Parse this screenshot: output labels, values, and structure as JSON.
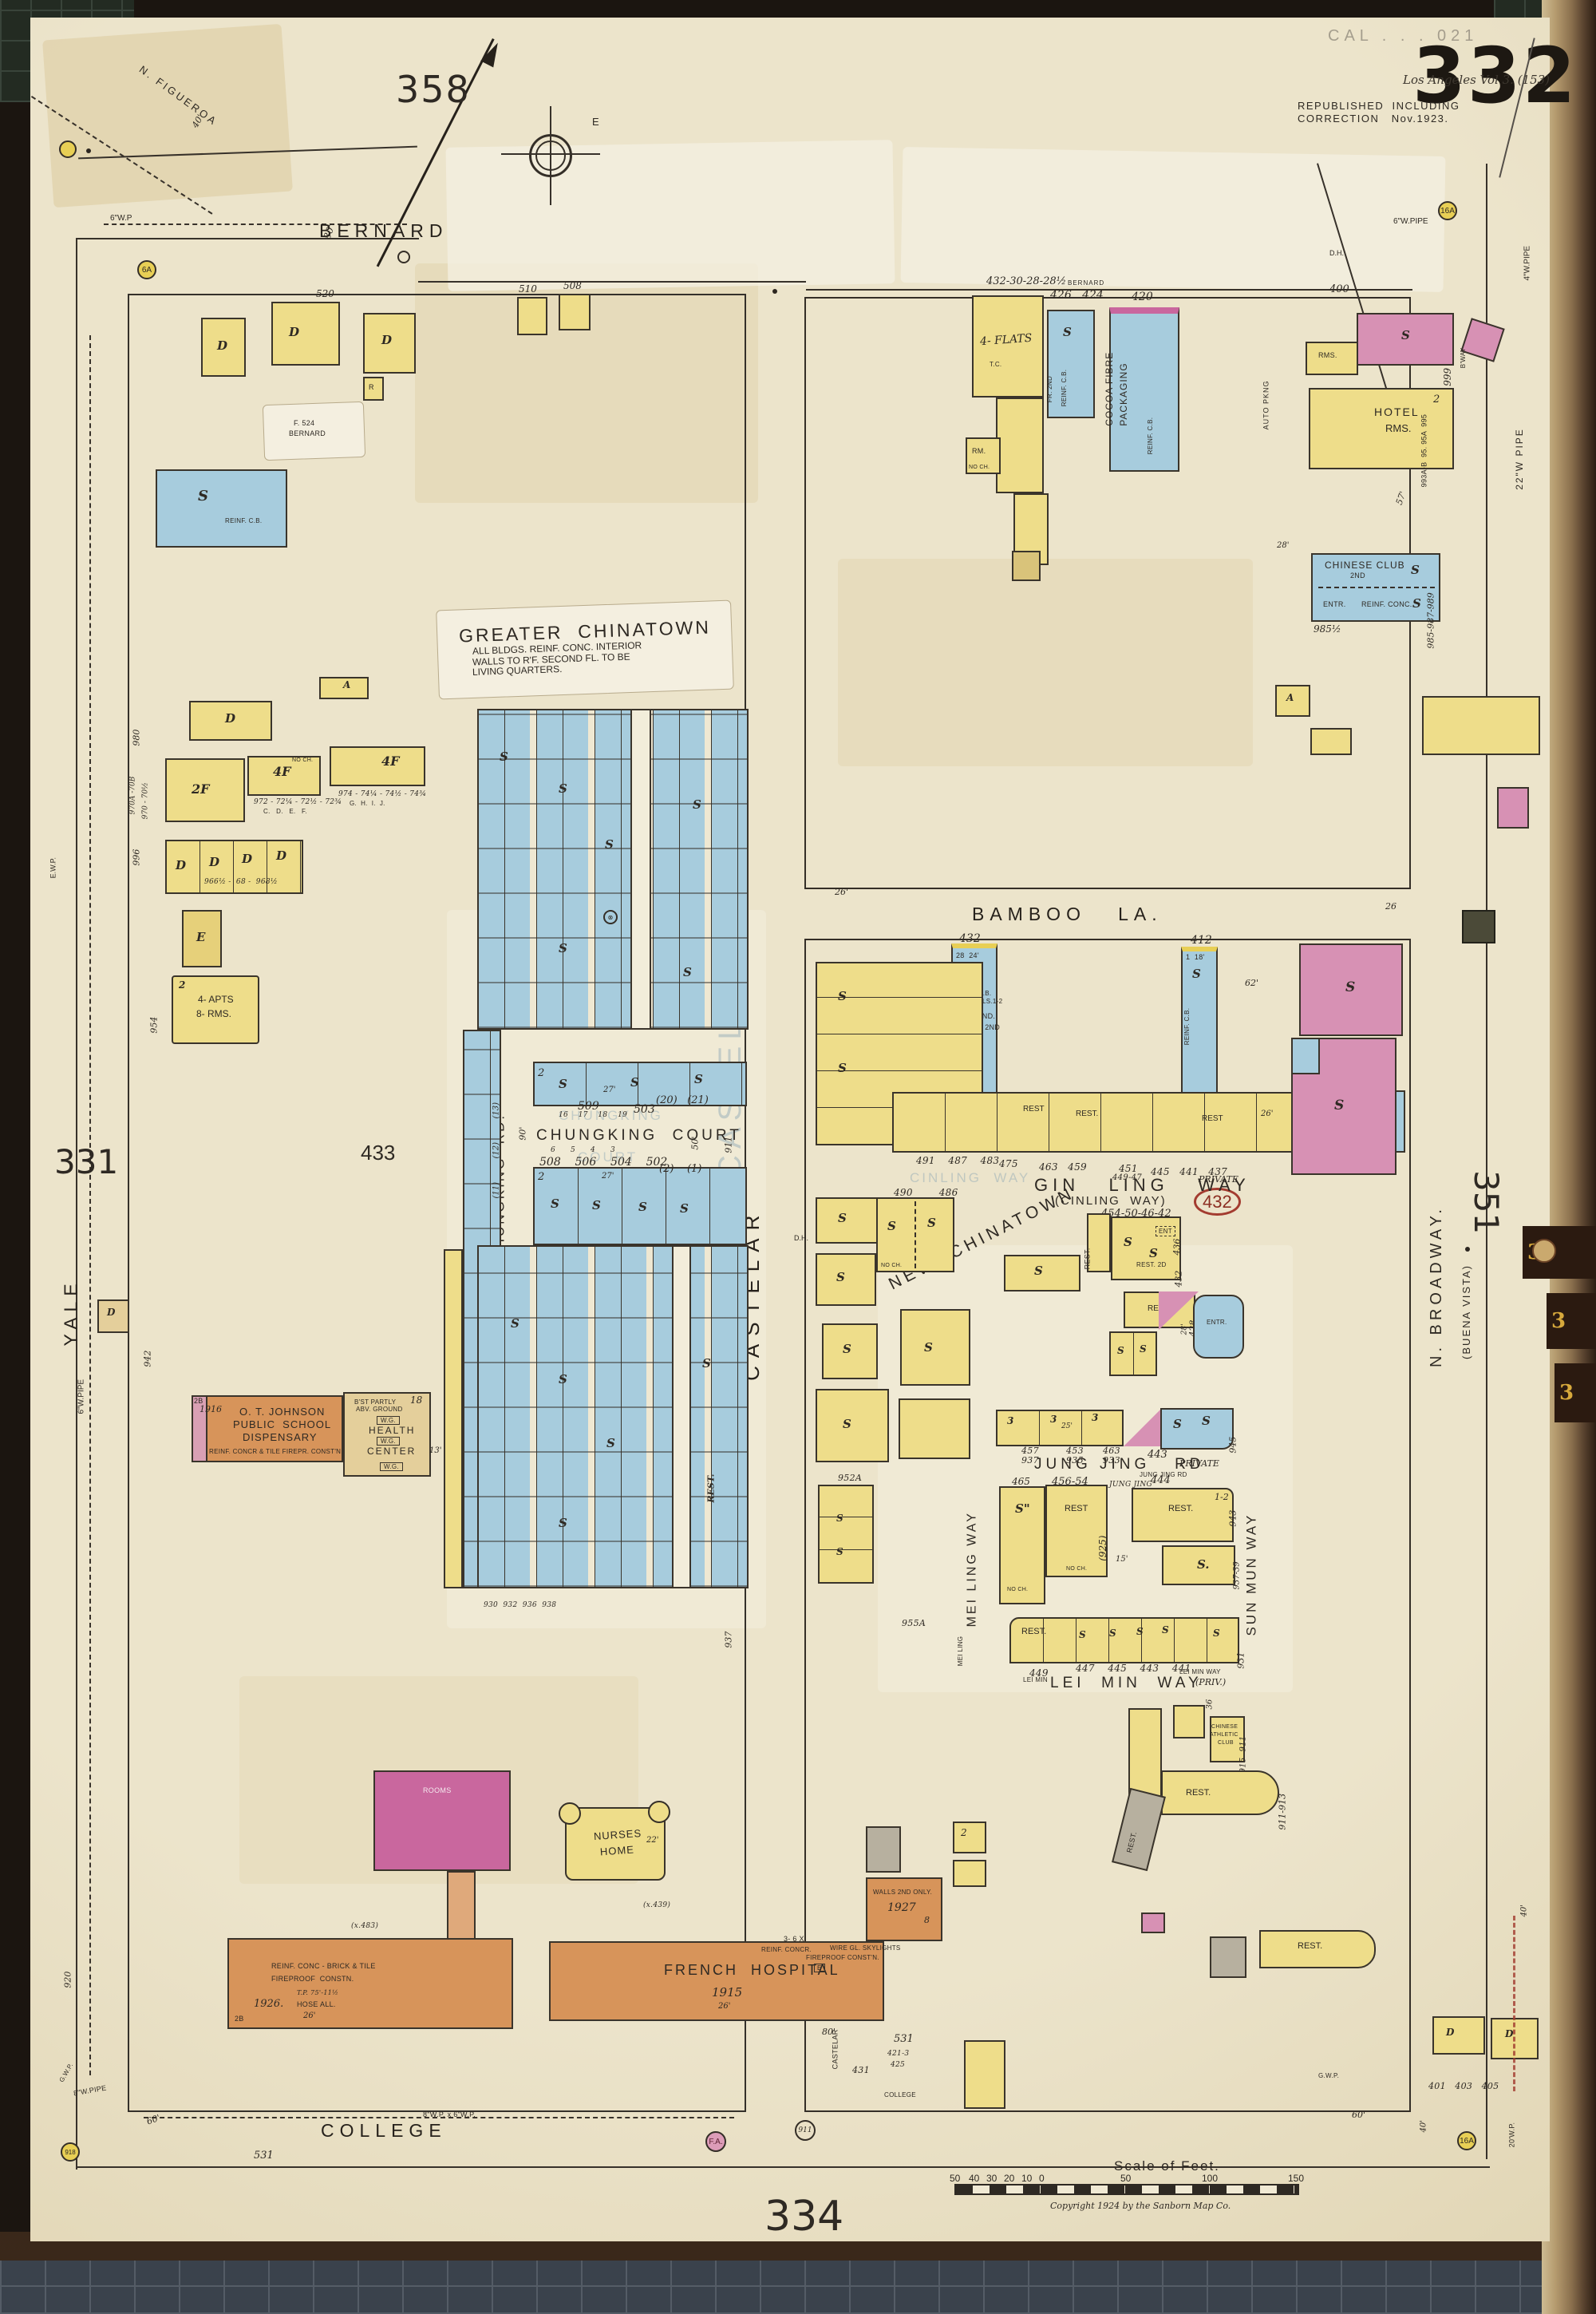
{
  "page": {
    "sheet": "332",
    "vol_stamp": "Los Angeles Vol 3. (153)",
    "faint_stamp": "CAL . . . 021",
    "rep1": "REPUBLISHED  INCLUDING",
    "rep2": "CORRECTION   Nov.1923.",
    "adj_top": "358",
    "adj_bottom": "334",
    "adj_left": "331",
    "adj_right": "351",
    "block_433": "433",
    "red_432": "432",
    "compass_e": "E"
  },
  "streets": {
    "bernard": "BERNARD",
    "bernard2": "BERNARD",
    "yale": "YALE",
    "castelar": "CASTELAR",
    "castelar2": "CASTELAR",
    "broadway1": "N. BROADWAY.",
    "broadway2": "(BUENA VISTA)",
    "college": "COLLEGE",
    "college2": "COLLEGE",
    "bamboo": "BAMBOO   LA.",
    "ginling": "GIN   LING   WAY",
    "ginling2": "(CINLING  WAY)",
    "ginling_priv": "PRIVATE",
    "ginling_nums": "454-50-46-42",
    "newchinatown": "NEW  CHINATOWN",
    "jungjing": "JUNG JING   RD",
    "jj_priv": "PRIVATE",
    "jj_tiny": "JUNG JING RD",
    "jj_sub1": "465",
    "jj_sub2": "456-54",
    "jj_sub3": "JUNG JING",
    "jj_sub4": "444",
    "meiling": "MEI LING WAY",
    "meiling2": "MEI LING",
    "sunmun": "SUN MUN WAY",
    "leimin": "LEI  MIN  WAY",
    "leimin_priv": "(PRIV.)",
    "leimin2": "LEI MIN",
    "leimin3": "LEI MIN WAY",
    "ck_court": "CHUNGKING  COURT",
    "ck_rd": "CHUNGKING  RD.",
    "figueroa": "N. FIGUEROA",
    "alley": "ALLEY",
    "private": "PRIVATE"
  },
  "ghosts": {
    "court1": "CHUNGKING",
    "court2": "COURT",
    "castelar": "CASTELAR",
    "ginling": "CINLING  WAY"
  },
  "notes": {
    "gc1": "GREATER  CHINATOWN",
    "gc2": "ALL BLDGS. REINF. CONC. INTERIOR",
    "gc3": "WALLS TO R'F. SECOND FL. TO BE",
    "gc4": "LIVING QUARTERS.",
    "slip524a": "F. 524",
    "slip524b": "BERNARD",
    "school1": "O. T. JOHNSON",
    "school2": "PUBLIC  SCHOOL",
    "school3": "DISPENSARY",
    "school4": "REINF. CONCR & TILE FIREPR. CONST'N",
    "school5": "1916",
    "school6": "2B",
    "hc1": "B'ST PARTLY",
    "hc2": "ABV. GROUND",
    "hc3": "HEALTH",
    "hc4": "CENTER",
    "wg": "W.G.",
    "hc18": "18",
    "hc13": "13'",
    "rooms": "ROOMS",
    "nurses1": "NURSES",
    "nurses2": "HOME",
    "fh1": "FRENCH  HOSPITAL",
    "fh2": "1915",
    "fh3": "REINF. CONC - BRICK & TILE",
    "fh4": "FIREPROOF  CONSTN.",
    "fh5": "1926.",
    "fh6": "HOSE ALL.",
    "fh7": "T.P. 75'-11½",
    "fh8": "2B",
    "an1": "WALLS 2ND ONLY.",
    "an2": "1927",
    "an3": "WIRE GL. SKYLIGHTS",
    "an4": "3- 6 X",
    "an5": "REINF. CONCR.",
    "an6": "FIREPROOF CONST'N.",
    "anE": "E",
    "x483": "(x.483)",
    "x439": "(x.439)",
    "b432n": "432",
    "b432a": "28  24'",
    "b432b": "REINF. C.B.",
    "b432c": "CONC. FLS.1-2",
    "b432d": "AIR COND.",
    "b432e": "CLUB RM. 2ND",
    "b412n": "412",
    "b412a": "1  18'",
    "b412b": "REINF. C.B.",
    "cocoa1": "COCOA FIBRE",
    "cocoa2": "PACKAGING",
    "cocoa3": "REINF. C.B.",
    "sreinf": "REINF. C.B.",
    "fr2": "FR. 2ND",
    "flats": "4- FLATS",
    "hotel1": "HOTEL",
    "hotel2": "RMS.",
    "cclub1": "CHINESE CLUB",
    "cclub2": "2ND",
    "cclub3": "REINF. CONC.",
    "auto": "AUTO PKNG",
    "dining1": "DINING",
    "dining2": "RM. 2ND",
    "rest2d": "REST. 2D",
    "cac1": "CHINESE",
    "cac2": "ATHLETIC",
    "cac3": "CLUB",
    "apts1": "4- APTS",
    "apts2": "8- RMS."
  },
  "numbers": {
    "bern_l1": "520",
    "bern_l2": "510",
    "bern_l3": "508",
    "bern_r1": "432-30-28-28½",
    "bern_r2": "426   424",
    "bern_r3": "420",
    "bern_r4": "400",
    "bway1": "999",
    "bway2": "B'WAY",
    "bway3": "993A-B  95. 95A  995",
    "bway4": "985-987-989",
    "bway5": "985½",
    "yale1": "980",
    "yale2": "996",
    "yale3": "970A -70B",
    "yale4": "970 - 70½",
    "yale5": "954",
    "yale6": "942",
    "row972": "972 - 72¼ - 72½ - 72¾",
    "row972b": "C.   D.   E.   F.",
    "row974": "974 - 74¼ - 74½ - 74¾",
    "row974b": "G.  H.  I.  J.",
    "row966": "966½ -  68 -  968½",
    "ck1": "509",
    "ck2": "503",
    "ck3": "16    17    18    19",
    "ck4": "(20)   (21)",
    "ck5": "6      5      4      3",
    "ck6": "508    506    504    502",
    "ck7": "(2)    (1)",
    "ck8": "(13)",
    "ck9": "(12)",
    "ck10": "(11)",
    "ck11": "930  932  936  938",
    "gl1": "491    487    483",
    "gl2": "475",
    "gl3": "463   459",
    "gl4": "451",
    "gl5": "449-47",
    "gl6": "445   441   437",
    "gl7": "490        486",
    "cast1": "911",
    "cast2": "937",
    "cast3": "952A",
    "cast4": "955A",
    "jj1": "457",
    "jj2": "937",
    "jj3": "453",
    "jj4": "935",
    "jj5": "463",
    "jj6": "933",
    "jj7": "443",
    "jj8": "945",
    "jj9": "943",
    "jj10": "937-39",
    "jj11": "(925)",
    "jj12": "1-2",
    "lm1": "449",
    "lm2": "447    445    443    441",
    "lm3": "931",
    "lm4": "915  911",
    "lm5": "911-913",
    "col1": "531",
    "col2": "531",
    "col3": "431",
    "col4": "421-3",
    "col5": "425",
    "col6": "401   403   405",
    "n436": "436",
    "n432": "432",
    "n428": "428",
    "n920": "920"
  },
  "measure": {
    "m80": "80'",
    "m40": "40'",
    "m26a": "26'",
    "m26b": "26",
    "m62": "62'",
    "m57": "57'",
    "m28": "28'",
    "m27": "27'",
    "m90": "90'",
    "m50": "50'",
    "m30": "30'",
    "m29": "29'",
    "m25": "25'",
    "m15": "15'",
    "m36": "36",
    "m22": "22'",
    "m60": "60'"
  },
  "pipes": {
    "p6wp": "6\"W.P",
    "p6wpipe": "6\"W.PIPE",
    "p4wpipe": "4\"W.PIPE",
    "p22": "22\"W PIPE",
    "p8x6": "8\"W.P. x 6\"W.P.",
    "p8": "8\"W.PIPE",
    "p20": "20'W.P.",
    "gwp": "G.W.P.",
    "ewp": "E.W.P."
  },
  "alarms": {
    "fa": "F.A.",
    "a6": "6A",
    "a16": "16A",
    "c918": "918",
    "c911": "911"
  },
  "marks": {
    "s": "S",
    "d": "D",
    "a": "A",
    "e": "E",
    "r": "R",
    "one": "1",
    "two": "2",
    "three": "3",
    "eight": "8",
    "four_f": "4F",
    "two_f": "2F",
    "rest": "REST.",
    "rest2": "REST",
    "rms": "RMS.",
    "rm": "RM.",
    "noch": "NO CH.",
    "dh": "D.H.",
    "ent": "ENT",
    "entr": "ENTR.",
    "tc": "T.C.",
    "s2": "S.",
    "sh": "S\"",
    "tab": "3"
  },
  "scale": {
    "title": "Scale of Feet.",
    "ticks": [
      "50",
      "40",
      "30",
      "20",
      "10",
      "0",
      "50",
      "100",
      "150"
    ],
    "copyright": "Copyright 1924 by the Sanborn Map Co."
  },
  "colors": {
    "paper": "#ece4cb",
    "yellow": "#eedd8a",
    "blue": "#a7ccdd",
    "pink": "#d791b4",
    "orange": "#d7945a",
    "ink": "#342e27",
    "gold": "#d7a93c",
    "red": "#a33c30"
  }
}
